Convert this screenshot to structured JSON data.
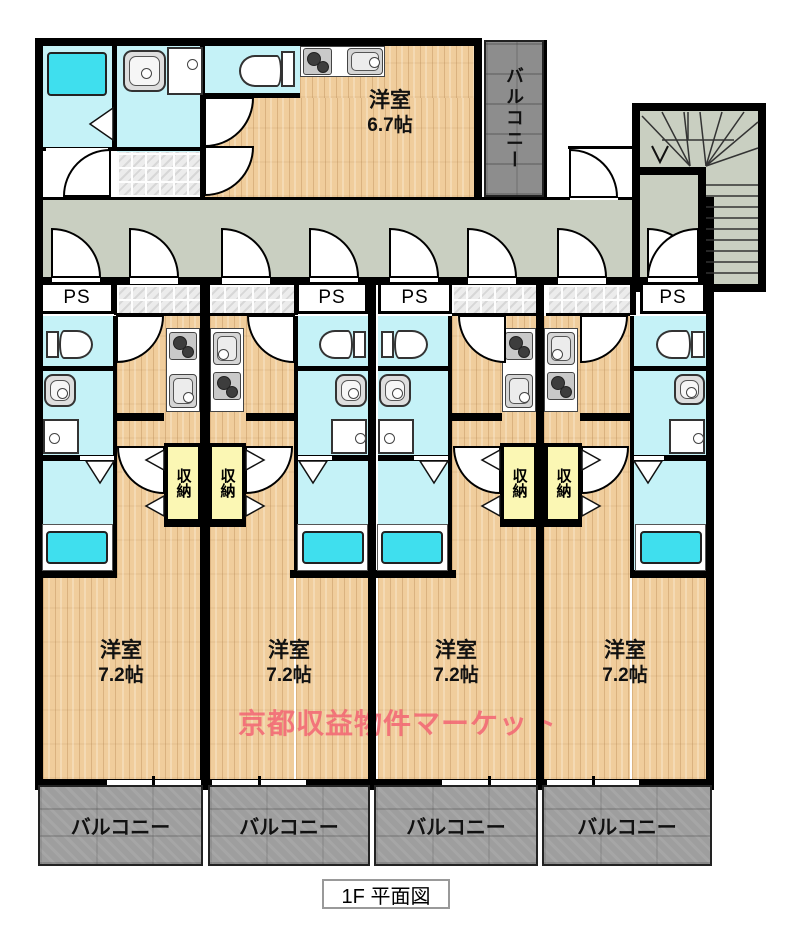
{
  "plan": {
    "caption": "1F 平面図",
    "watermark": "京都収益物件マーケット",
    "labels": {
      "ps": "PS",
      "storage": "収納",
      "balcony": "バルコニー"
    },
    "rooms": {
      "top": {
        "name": "洋室",
        "size": "6.7帖"
      }
    },
    "units": [
      {
        "name": "洋室",
        "size": "7.2帖"
      },
      {
        "name": "洋室",
        "size": "7.2帖"
      },
      {
        "name": "洋室",
        "size": "7.2帖"
      },
      {
        "name": "洋室",
        "size": "7.2帖"
      }
    ],
    "colors": {
      "wall": "#000000",
      "wet_room": "#c5f2f7",
      "bathtub": "#3fdfee",
      "wood_floor": "#f0cd9c",
      "corridor": "#c9cfc1",
      "balcony": "#9e9e9e",
      "balcony_top": "#8d8d8d",
      "storage": "#fbf7b4",
      "watermark": "#f26470"
    }
  }
}
